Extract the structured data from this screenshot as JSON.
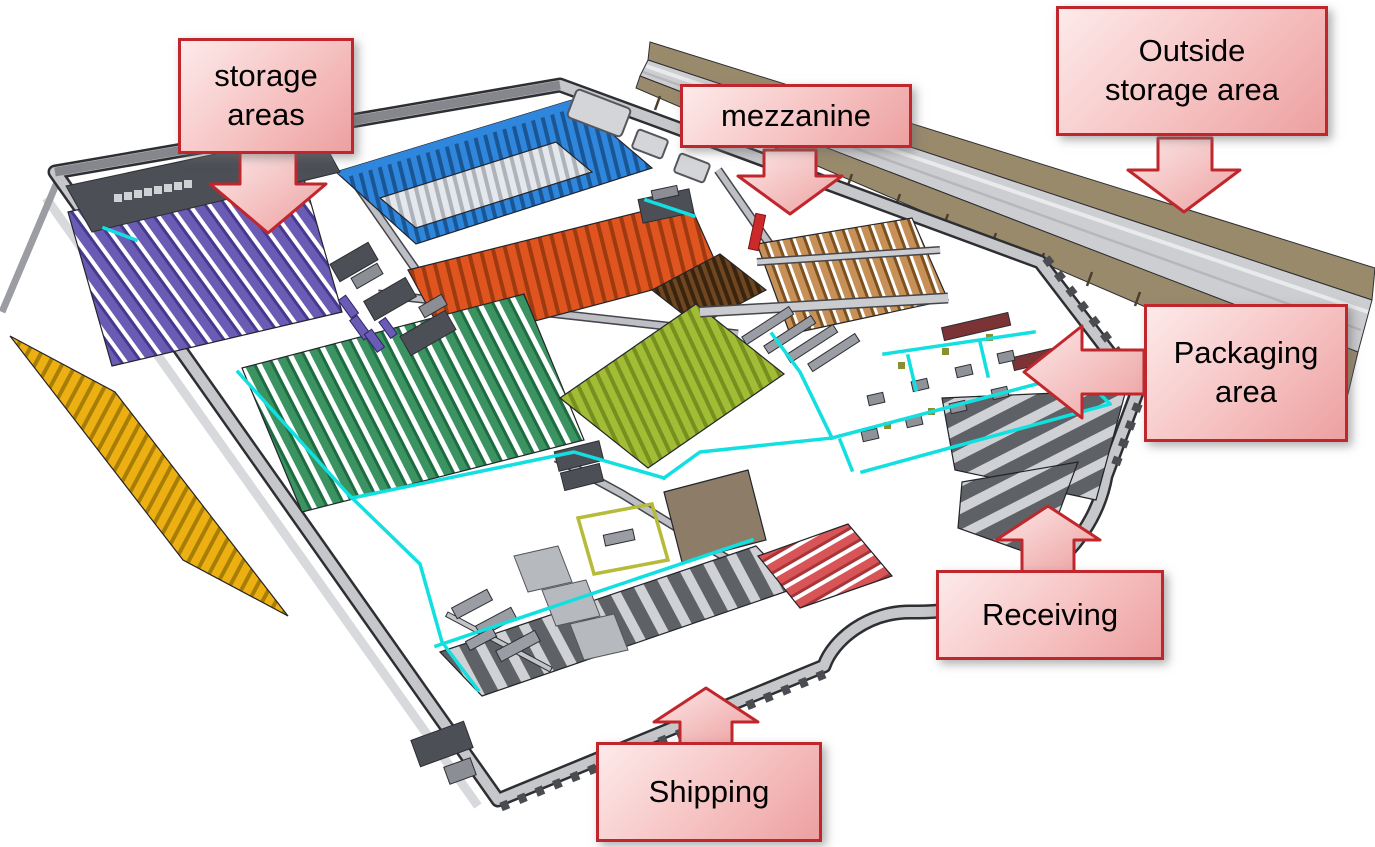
{
  "page": {
    "background": "#ffffff"
  },
  "callouts": {
    "storage": {
      "line1": "storage",
      "line2": "areas"
    },
    "mezzanine": {
      "line1": "mezzanine"
    },
    "outside": {
      "line1": "Outside",
      "line2": "storage area"
    },
    "packaging": {
      "line1": "Packaging",
      "line2": "area"
    },
    "receiving": {
      "line1": "Receiving"
    },
    "shipping": {
      "line1": "Shipping"
    }
  },
  "callout_style": {
    "border": "#c0272d",
    "fill_top": "#fde8e8",
    "fill_bottom": "#eda0a0",
    "text_color": "#000000"
  },
  "colors": {
    "floor": "#ffffff",
    "wall": "#c6c7ca",
    "wall_dark": "#85878d",
    "structure_dark": "#4d4f57",
    "structure_mid": "#8b8e94",
    "purple": "#6a5cb4",
    "purple_dark": "#463a8e",
    "blue": "#2f86dd",
    "blue_dark": "#1b5694",
    "rack_gray": "#e4e7eb",
    "rack_gray_dark": "#aeb3ba",
    "orange": "#e0551f",
    "orange_dark": "#9e3a10",
    "green": "#3a9360",
    "green_dark": "#1f6b42",
    "olive": "#a2bc35",
    "olive_dark": "#75901e",
    "brown": "#6e4722",
    "brown_dark": "#3a240e",
    "mezzanine_tan": "#c79057",
    "mezzanine_tan_dark": "#7c5020",
    "yellow": "#edb013",
    "yellow_dark": "#a87d06",
    "red_chute": "#d85456",
    "red_chute_dark": "#a83638",
    "bench_red": "#7b3336",
    "conveyor": "#12dfe0",
    "dock_strip": "#5e6166",
    "dock_floor": "#cfd1d4",
    "outside_tan": "#9a8a6c",
    "outside_roof": "#cdced1",
    "accent_red": "#cc2a2a",
    "gantry_yellow": "#b7bb3a"
  }
}
